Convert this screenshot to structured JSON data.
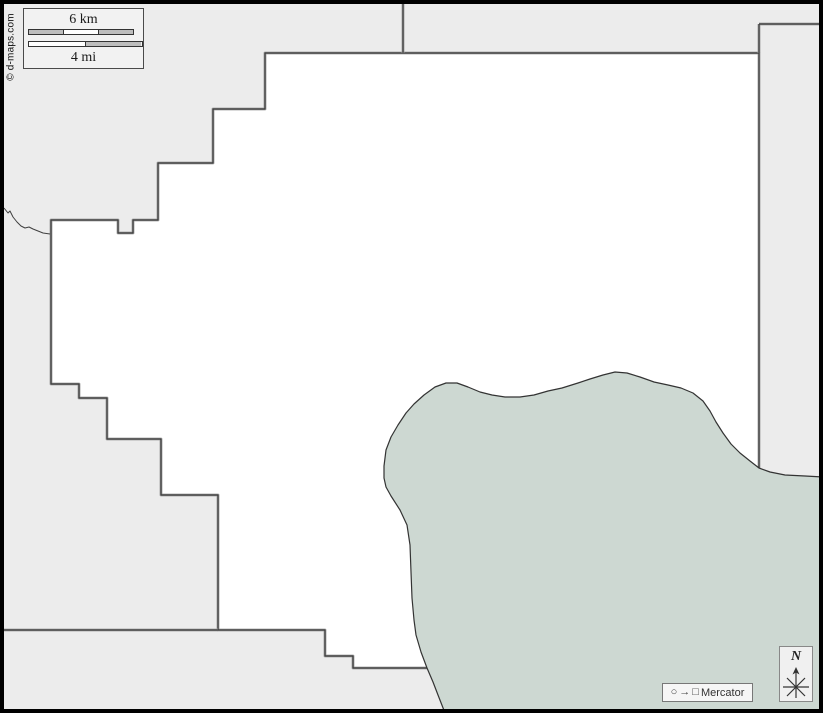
{
  "map": {
    "copyright": "© d-maps.com",
    "scale": {
      "km_label": "6 km",
      "mi_label": "4 mi"
    },
    "projection": {
      "label": "Mercator",
      "circle_glyph": "○",
      "arrow_glyph": "→",
      "square_glyph": "□"
    },
    "compass": {
      "north_label": "N"
    },
    "colors": {
      "land_neighbor": "#ececec",
      "county_fill": "#ffffff",
      "water": "#cdd8d2",
      "boundary": "#3a3a3a",
      "boundary_halo": "#9d9d9d",
      "frame": "#000000",
      "panel_bg": "#f2f2f2",
      "bar_gray": "#bdbdbd"
    }
  }
}
